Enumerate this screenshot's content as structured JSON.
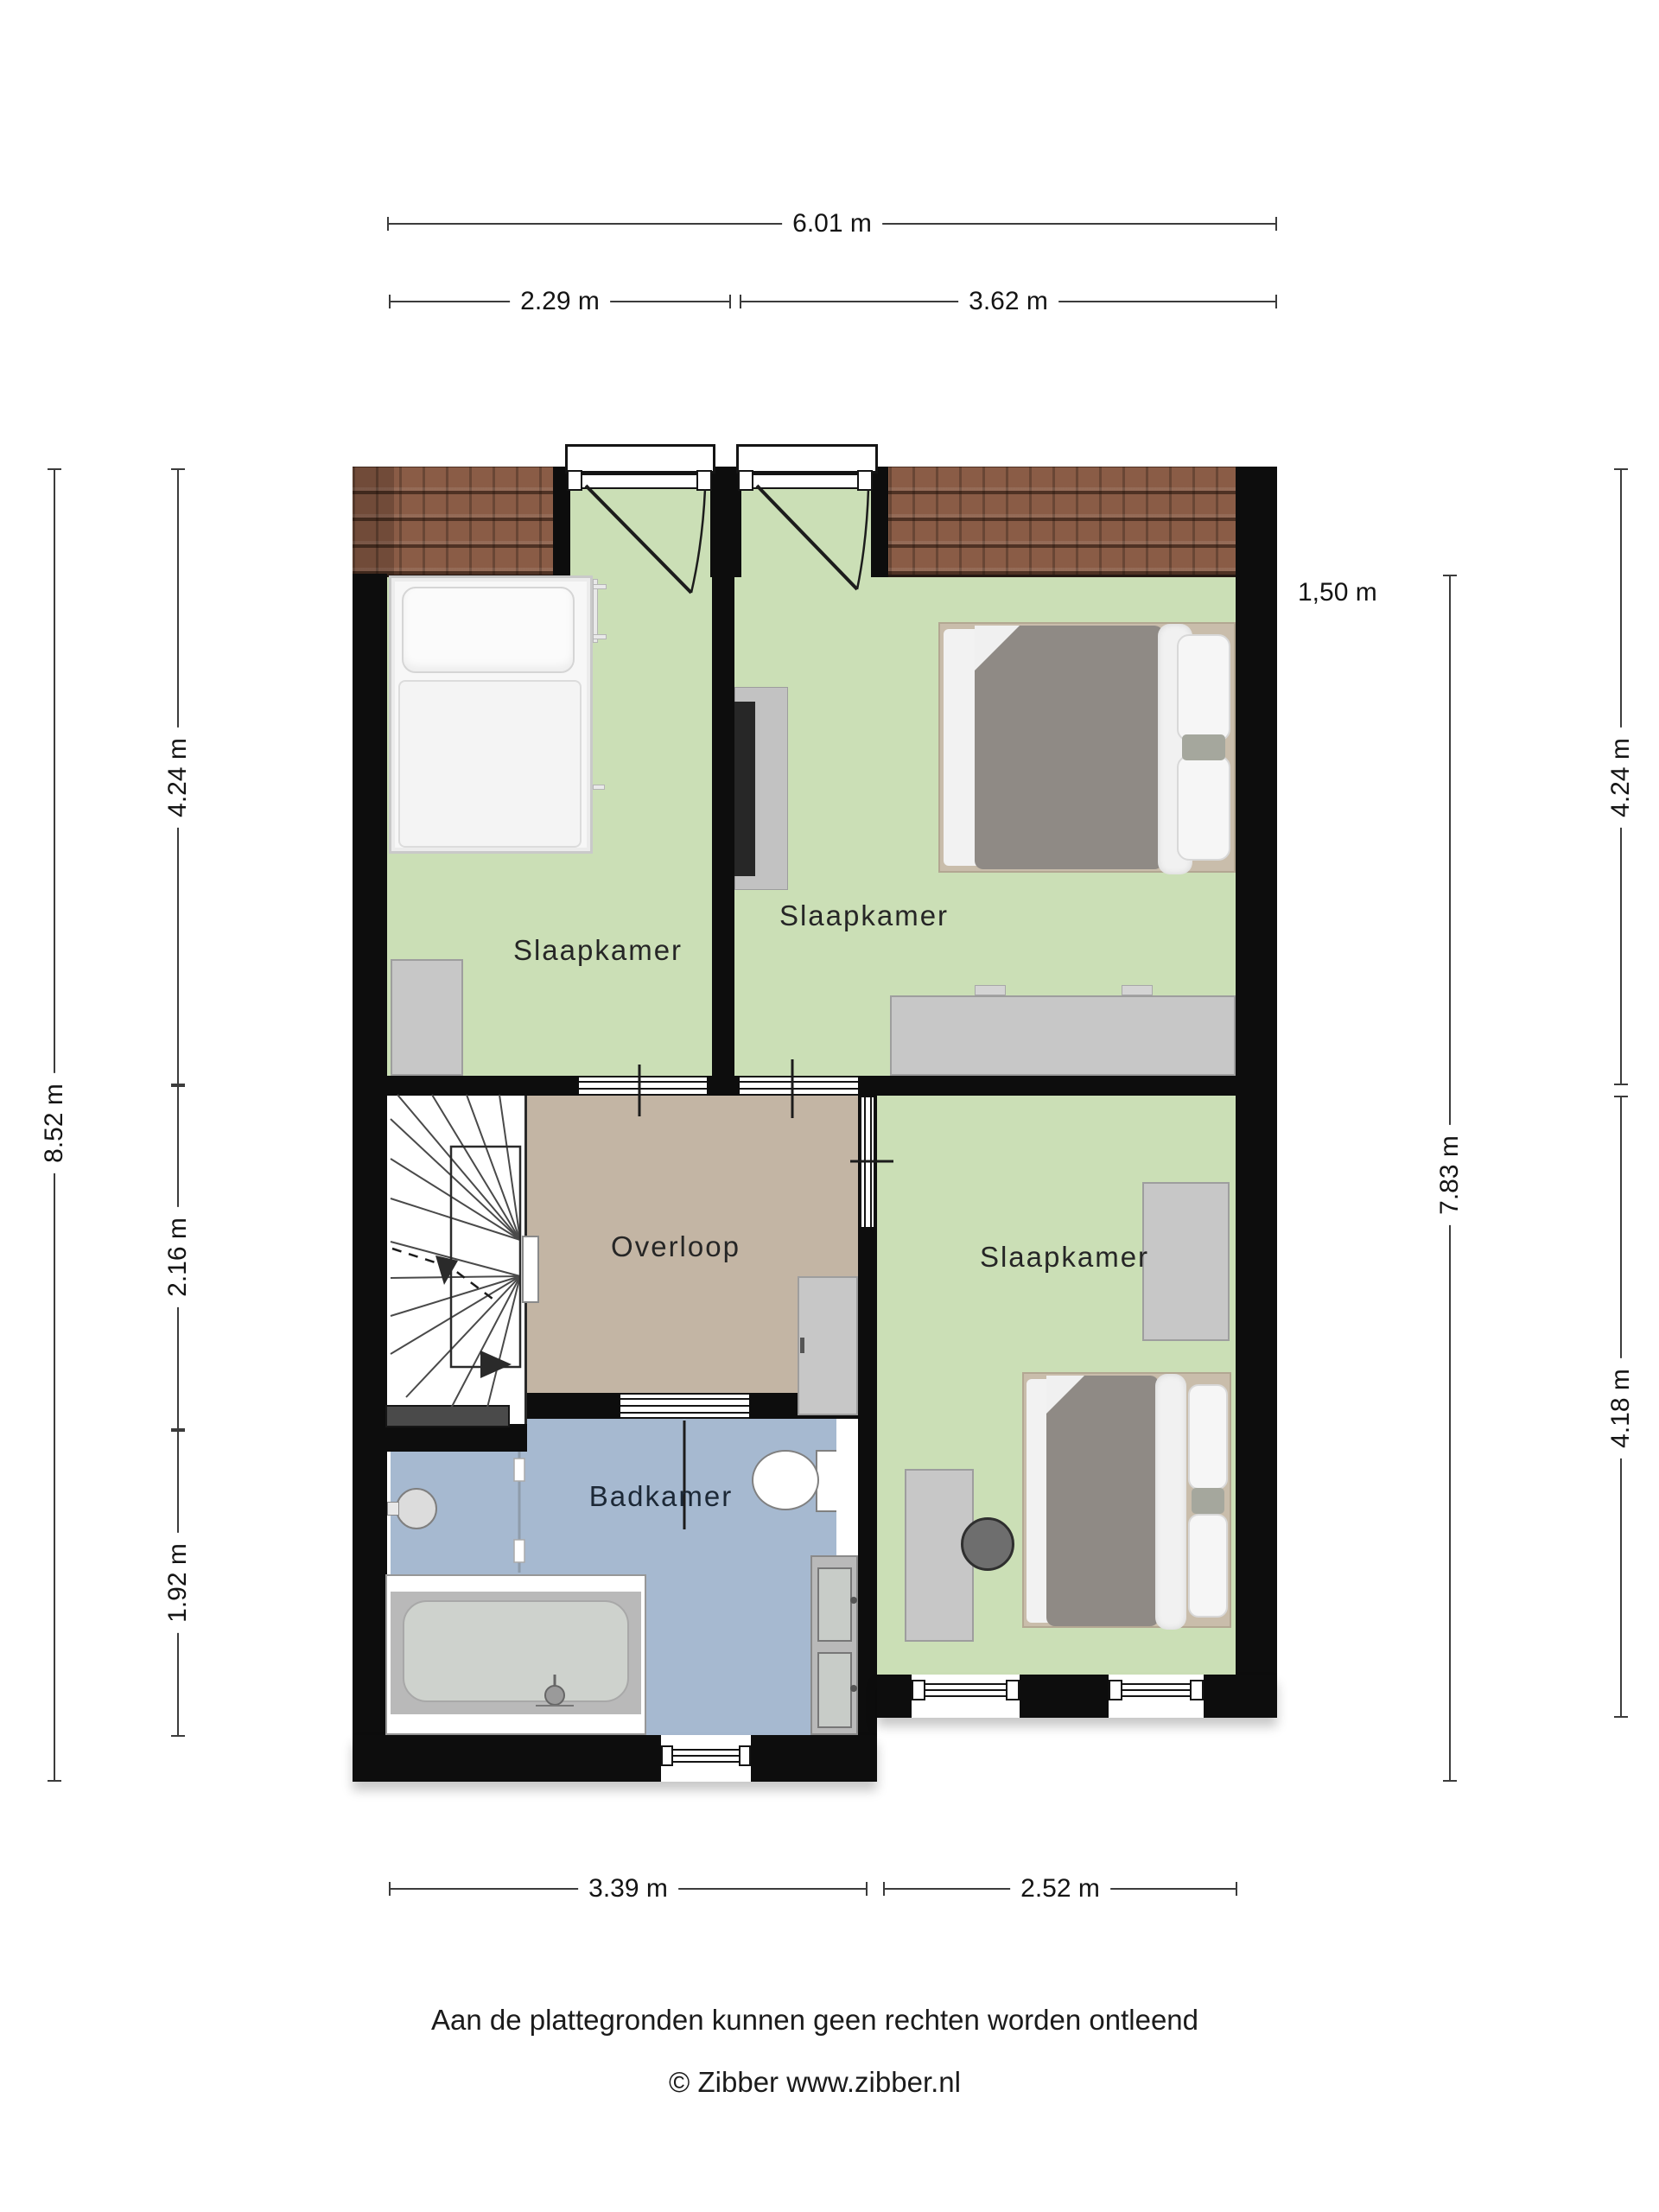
{
  "footer": {
    "disclaimer": "Aan de plattegronden kunnen geen rechten worden ontleend",
    "copyright": "© Zibber www.zibber.nl"
  },
  "rooms": {
    "bedroom_top_left": {
      "label": "Slaapkamer"
    },
    "bedroom_top_right": {
      "label": "Slaapkamer"
    },
    "bedroom_bottom_right": {
      "label": "Slaapkamer"
    },
    "landing": {
      "label": "Overloop"
    },
    "bathroom": {
      "label": "Badkamer"
    }
  },
  "dimensions": {
    "overall_width": {
      "label": "6.01 m"
    },
    "top_left_width": {
      "label": "2.29 m"
    },
    "top_right_width": {
      "label": "3.62 m"
    },
    "overall_height": {
      "label": "8.52 m"
    },
    "left_upper": {
      "label": "4.24 m"
    },
    "left_middle": {
      "label": "2.16 m"
    },
    "left_lower": {
      "label": "1.92 m"
    },
    "knee_wall_height": {
      "label": "1,50 m"
    },
    "right_upper": {
      "label": "4.24 m"
    },
    "right_inner": {
      "label": "7.83 m"
    },
    "right_lower": {
      "label": "4.18 m"
    },
    "bottom_left_width": {
      "label": "3.39 m"
    },
    "bottom_right_width": {
      "label": "2.52 m"
    }
  },
  "colors": {
    "room_green": "#cbdfb6",
    "landing_beige": "#c3b5a4",
    "bathroom_blue": "#a6b9d0",
    "wall_black": "#0d0d0d",
    "roof_tile_brown": "#8a5c46"
  }
}
